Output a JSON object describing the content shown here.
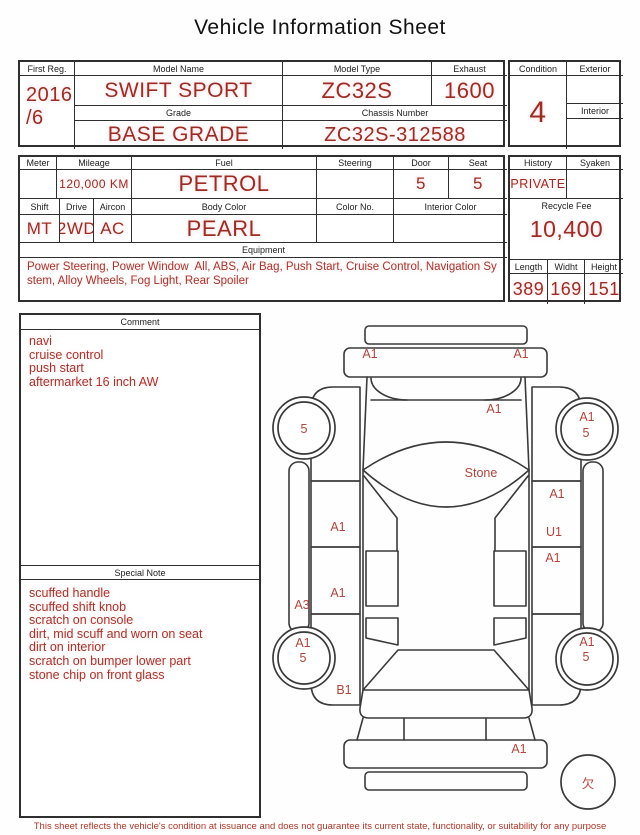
{
  "title": "Vehicle Information Sheet",
  "colors": {
    "value_red": "#9b2d22",
    "text_red": "#a8352a",
    "diagram_red": "#b5443a",
    "disclaimer_red": "#b23527",
    "line": "#2f2f2f"
  },
  "top_table": {
    "first_reg": {
      "label": "First Reg.",
      "lines": [
        "2016",
        "/6"
      ]
    },
    "model_name": {
      "label": "Model Name",
      "value": "SWIFT SPORT"
    },
    "model_type": {
      "label": "Model Type",
      "value": "ZC32S"
    },
    "exhaust": {
      "label": "Exhaust",
      "value": "1600"
    },
    "grade": {
      "label": "Grade",
      "value": "BASE GRADE"
    },
    "chassis_number": {
      "label": "Chassis Number",
      "value": "ZC32S-312588"
    },
    "condition": {
      "label": "Condition",
      "value": "4"
    },
    "exterior": {
      "label": "Exterior",
      "value": ""
    },
    "interior": {
      "label": "Interior",
      "value": ""
    }
  },
  "spec_table": {
    "meter": {
      "label": "Meter",
      "value": ""
    },
    "mileage": {
      "label": "Mileage",
      "value": "120,000 KM"
    },
    "fuel": {
      "label": "Fuel",
      "value": "PETROL"
    },
    "steering": {
      "label": "Steering",
      "value": ""
    },
    "door": {
      "label": "Door",
      "value": "5"
    },
    "seat": {
      "label": "Seat",
      "value": "5"
    },
    "shift": {
      "label": "Shift",
      "value": "MT"
    },
    "drive": {
      "label": "Drive",
      "value": "2WD"
    },
    "aircon": {
      "label": "Aircon",
      "value": "AC"
    },
    "body_color": {
      "label": "Body Color",
      "value": "PEARL"
    },
    "color_no": {
      "label": "Color No.",
      "value": ""
    },
    "interior_color": {
      "label": "Interior Color",
      "value": ""
    },
    "equipment": {
      "label": "Equipment",
      "value": "Power Steering, Power Window  All, ABS, Air Bag, Push Start, Cruise Control, Navigation System, Alloy Wheels, Fog Light, Rear Spoiler"
    }
  },
  "history_table": {
    "history": {
      "label": "History",
      "value": "PRIVATE"
    },
    "syaken": {
      "label": "Syaken",
      "value": ""
    },
    "recycle_fee": {
      "label": "Recycle Fee",
      "value": "10,400"
    },
    "length": {
      "label": "Length",
      "value": "389"
    },
    "width": {
      "label": "Widht",
      "value": "169"
    },
    "height": {
      "label": "Height",
      "value": "151"
    }
  },
  "comment": {
    "label": "Comment",
    "lines": [
      "navi",
      "cruise control",
      "push start",
      "aftermarket 16 inch AW"
    ]
  },
  "special_note": {
    "label": "Special Note",
    "lines": [
      "scuffed handle",
      "scuffed shift knob",
      "scratch on console",
      "dirt, mid scuff and worn on seat",
      "dirt on interior",
      "scratch on bumper lower part",
      "stone chip on front glass"
    ]
  },
  "diagram": {
    "labels": [
      {
        "part": "front-bumper-left",
        "text": "A1",
        "x": 370,
        "y": 358
      },
      {
        "part": "front-bumper-right",
        "text": "A1",
        "x": 521,
        "y": 358
      },
      {
        "part": "hood",
        "text": "A1",
        "x": 494,
        "y": 413
      },
      {
        "part": "front-left-wheel",
        "text": "5",
        "x": 304,
        "y": 433
      },
      {
        "part": "front-right-wheel",
        "text": "A1",
        "x": 587,
        "y": 421
      },
      {
        "part": "front-right-wheel",
        "text": "5",
        "x": 586,
        "y": 437
      },
      {
        "part": "windshield",
        "text": "Stone",
        "x": 481,
        "y": 477
      },
      {
        "part": "right-front-fender",
        "text": "A1",
        "x": 557,
        "y": 498
      },
      {
        "part": "left-front-door",
        "text": "A1",
        "x": 338,
        "y": 531
      },
      {
        "part": "right-front-door",
        "text": "U1",
        "x": 554,
        "y": 536
      },
      {
        "part": "right-rear-door",
        "text": "A1",
        "x": 553,
        "y": 562
      },
      {
        "part": "left-rear-door",
        "text": "A1",
        "x": 338,
        "y": 597
      },
      {
        "part": "left-sill",
        "text": "A3",
        "x": 302,
        "y": 609
      },
      {
        "part": "rear-left-wheel",
        "text": "A1",
        "x": 303,
        "y": 647
      },
      {
        "part": "rear-left-wheel",
        "text": "5",
        "x": 303,
        "y": 662
      },
      {
        "part": "rear-right-wheel",
        "text": "A1",
        "x": 587,
        "y": 646
      },
      {
        "part": "rear-right-wheel",
        "text": "5",
        "x": 586,
        "y": 661
      },
      {
        "part": "left-quarter",
        "text": "B1",
        "x": 344,
        "y": 694
      },
      {
        "part": "rear-bumper-right",
        "text": "A1",
        "x": 519,
        "y": 753
      },
      {
        "part": "spare-tire",
        "text": "欠",
        "x": 588,
        "y": 788,
        "size": 15
      }
    ]
  },
  "footer": {
    "disclaimer": "This sheet reflects the vehicle's condition at issuance and does not guarantee its current state, functionality, or suitability for any purpose"
  }
}
